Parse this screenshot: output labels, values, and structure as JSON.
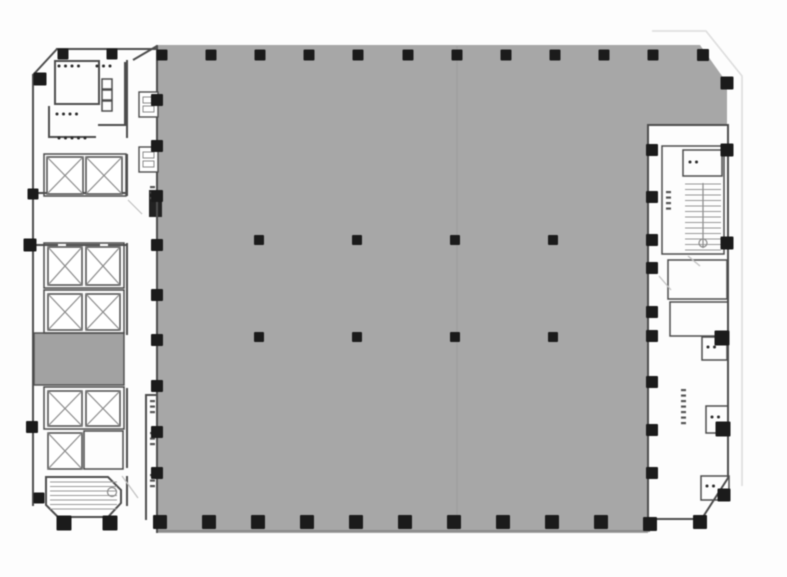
{
  "canvas": {
    "width": 787,
    "height": 577
  },
  "colors": {
    "background": "#fdfdfd",
    "open_area_fill": "#a7a7a7",
    "service_room_fill": "#a2a2a2",
    "wall": "#4d4d4d",
    "wall_light": "#8a8a8a",
    "column": "#1b1b1b",
    "faint_outline": "#dcdcdc",
    "tread": "#999999",
    "mark": "#2a2a2a",
    "door": "#c0c0c0",
    "seam": "rgba(100,100,100,0.14)"
  },
  "floor_plan": {
    "open_area_path": "M157,45 L700,45 L727,83 L727,125 L648,125 L648,533 L157,533 Z",
    "faint_outline_path": "M652,31 L706,31 L742,76 L742,486",
    "seam_line": {
      "x1": 457,
      "y1": 46,
      "x2": 457,
      "y2": 532
    },
    "gray_bottom_edge": {
      "x1": 157,
      "y1": 531,
      "x2": 650,
      "y2": 531
    },
    "columns": [
      {
        "x": 162,
        "y": 55,
        "s": 11
      },
      {
        "x": 211,
        "y": 55,
        "s": 11
      },
      {
        "x": 260,
        "y": 55,
        "s": 11
      },
      {
        "x": 309,
        "y": 55,
        "s": 11
      },
      {
        "x": 358,
        "y": 55,
        "s": 11
      },
      {
        "x": 408,
        "y": 55,
        "s": 11
      },
      {
        "x": 457,
        "y": 55,
        "s": 11
      },
      {
        "x": 506,
        "y": 55,
        "s": 11
      },
      {
        "x": 555,
        "y": 55,
        "s": 11
      },
      {
        "x": 604,
        "y": 55,
        "s": 11
      },
      {
        "x": 653,
        "y": 55,
        "s": 11
      },
      {
        "x": 703,
        "y": 55,
        "s": 12
      },
      {
        "x": 727,
        "y": 83,
        "s": 13
      },
      {
        "x": 727,
        "y": 150,
        "s": 13
      },
      {
        "x": 727,
        "y": 243,
        "s": 13
      },
      {
        "x": 722,
        "y": 338,
        "s": 15
      },
      {
        "x": 723,
        "y": 429,
        "s": 15
      },
      {
        "x": 724,
        "y": 495,
        "s": 13
      },
      {
        "x": 652,
        "y": 150,
        "s": 12
      },
      {
        "x": 652,
        "y": 197,
        "s": 12
      },
      {
        "x": 652,
        "y": 240,
        "s": 12
      },
      {
        "x": 652,
        "y": 268,
        "s": 12
      },
      {
        "x": 652,
        "y": 312,
        "s": 12
      },
      {
        "x": 652,
        "y": 336,
        "s": 12
      },
      {
        "x": 652,
        "y": 382,
        "s": 12
      },
      {
        "x": 652,
        "y": 430,
        "s": 12
      },
      {
        "x": 652,
        "y": 473,
        "s": 12
      },
      {
        "x": 160,
        "y": 522,
        "s": 14
      },
      {
        "x": 209,
        "y": 522,
        "s": 14
      },
      {
        "x": 258,
        "y": 522,
        "s": 14
      },
      {
        "x": 307,
        "y": 522,
        "s": 14
      },
      {
        "x": 356,
        "y": 522,
        "s": 14
      },
      {
        "x": 405,
        "y": 522,
        "s": 14
      },
      {
        "x": 454,
        "y": 522,
        "s": 14
      },
      {
        "x": 503,
        "y": 522,
        "s": 14
      },
      {
        "x": 552,
        "y": 522,
        "s": 14
      },
      {
        "x": 601,
        "y": 522,
        "s": 14
      },
      {
        "x": 650,
        "y": 524,
        "s": 14
      },
      {
        "x": 700,
        "y": 522,
        "s": 14
      },
      {
        "x": 157,
        "y": 100,
        "s": 12
      },
      {
        "x": 157,
        "y": 146,
        "s": 12
      },
      {
        "x": 157,
        "y": 196,
        "s": 12
      },
      {
        "x": 157,
        "y": 245,
        "s": 12
      },
      {
        "x": 157,
        "y": 295,
        "s": 12
      },
      {
        "x": 157,
        "y": 340,
        "s": 12
      },
      {
        "x": 157,
        "y": 386,
        "s": 12
      },
      {
        "x": 157,
        "y": 432,
        "s": 12
      },
      {
        "x": 157,
        "y": 473,
        "s": 12
      },
      {
        "x": 259,
        "y": 240,
        "s": 10
      },
      {
        "x": 357,
        "y": 240,
        "s": 10
      },
      {
        "x": 455,
        "y": 240,
        "s": 10
      },
      {
        "x": 553,
        "y": 240,
        "s": 10
      },
      {
        "x": 259,
        "y": 337,
        "s": 10
      },
      {
        "x": 357,
        "y": 337,
        "s": 10
      },
      {
        "x": 455,
        "y": 337,
        "s": 10
      },
      {
        "x": 553,
        "y": 337,
        "s": 10
      },
      {
        "x": 63,
        "y": 54,
        "s": 11
      },
      {
        "x": 112,
        "y": 54,
        "s": 11
      },
      {
        "x": 40,
        "y": 79,
        "s": 13
      },
      {
        "x": 33,
        "y": 194,
        "s": 11
      },
      {
        "x": 30,
        "y": 245,
        "s": 13
      },
      {
        "x": 32,
        "y": 427,
        "s": 12
      },
      {
        "x": 39,
        "y": 498,
        "s": 11
      },
      {
        "x": 64,
        "y": 523,
        "s": 15
      },
      {
        "x": 110,
        "y": 523,
        "s": 15
      }
    ],
    "walls": [
      {
        "x": 32,
        "y": 74,
        "w": 2,
        "h": 432
      },
      {
        "x": 56,
        "y": 48,
        "w": 102,
        "h": 2
      },
      {
        "x": 54,
        "y": 60,
        "w": 2,
        "h": 45
      },
      {
        "x": 54,
        "y": 60,
        "w": 46,
        "h": 2
      },
      {
        "x": 98,
        "y": 60,
        "w": 2,
        "h": 45
      },
      {
        "x": 54,
        "y": 103,
        "w": 46,
        "h": 2
      },
      {
        "x": 124,
        "y": 62,
        "w": 2,
        "h": 64
      },
      {
        "x": 98,
        "y": 124,
        "w": 28,
        "h": 2
      },
      {
        "x": 48,
        "y": 106,
        "w": 2,
        "h": 32
      },
      {
        "x": 48,
        "y": 136,
        "w": 48,
        "h": 2
      },
      {
        "x": 126,
        "y": 60,
        "w": 2,
        "h": 78
      },
      {
        "x": 126,
        "y": 154,
        "w": 2,
        "h": 42
      },
      {
        "x": 126,
        "y": 243,
        "w": 2,
        "h": 92
      },
      {
        "x": 126,
        "y": 388,
        "w": 2,
        "h": 80
      },
      {
        "x": 126,
        "y": 476,
        "w": 2,
        "h": 30
      },
      {
        "x": 36,
        "y": 192,
        "w": 22,
        "h": 2
      },
      {
        "x": 66,
        "y": 192,
        "w": 34,
        "h": 2
      },
      {
        "x": 108,
        "y": 192,
        "w": 18,
        "h": 2
      },
      {
        "x": 36,
        "y": 244,
        "w": 22,
        "h": 2
      },
      {
        "x": 66,
        "y": 244,
        "w": 34,
        "h": 2
      },
      {
        "x": 108,
        "y": 244,
        "w": 18,
        "h": 2
      },
      {
        "x": 145,
        "y": 394,
        "w": 2,
        "h": 126
      },
      {
        "x": 145,
        "y": 394,
        "w": 13,
        "h": 2
      },
      {
        "x": 156,
        "y": 45,
        "w": 2,
        "h": 488
      },
      {
        "x": 647,
        "y": 125,
        "w": 2,
        "h": 395
      },
      {
        "x": 647,
        "y": 124,
        "w": 82,
        "h": 2
      },
      {
        "x": 727,
        "y": 125,
        "w": 2,
        "h": 354
      },
      {
        "x": 648,
        "y": 518,
        "w": 54,
        "h": 2
      }
    ],
    "diag_walls": [
      {
        "x1": 33,
        "y1": 75,
        "x2": 57,
        "y2": 49
      },
      {
        "x1": 133,
        "y1": 60,
        "x2": 157,
        "y2": 46
      },
      {
        "x1": 728,
        "y1": 478,
        "x2": 701,
        "y2": 520
      }
    ],
    "room_outlines": [
      {
        "x": 44,
        "y": 154,
        "w": 82,
        "h": 42
      },
      {
        "x": 44,
        "y": 243,
        "w": 80,
        "h": 45
      },
      {
        "x": 44,
        "y": 290,
        "w": 80,
        "h": 43
      },
      {
        "x": 44,
        "y": 387,
        "w": 80,
        "h": 42
      },
      {
        "x": 84,
        "y": 431,
        "w": 39,
        "h": 38
      },
      {
        "x": 662,
        "y": 146,
        "w": 62,
        "h": 108
      },
      {
        "x": 683,
        "y": 150,
        "w": 39,
        "h": 26
      },
      {
        "x": 668,
        "y": 260,
        "w": 59,
        "h": 39
      },
      {
        "x": 670,
        "y": 302,
        "w": 58,
        "h": 34
      },
      {
        "x": 702,
        "y": 337,
        "w": 25,
        "h": 23
      },
      {
        "x": 706,
        "y": 406,
        "w": 22,
        "h": 27
      },
      {
        "x": 701,
        "y": 476,
        "w": 28,
        "h": 24
      },
      {
        "x": 102,
        "y": 79,
        "w": 10,
        "h": 10
      },
      {
        "x": 102,
        "y": 90,
        "w": 10,
        "h": 10
      },
      {
        "x": 102,
        "y": 101,
        "w": 10,
        "h": 10
      }
    ],
    "filled_rooms": [
      {
        "x": 34,
        "y": 333,
        "w": 90,
        "h": 52,
        "fill": "service"
      },
      {
        "x": 149,
        "y": 190,
        "w": 13,
        "h": 27,
        "fill": "dark"
      }
    ],
    "elevators": [
      {
        "x": 47,
        "y": 157,
        "w": 36,
        "h": 37
      },
      {
        "x": 86,
        "y": 157,
        "w": 36,
        "h": 37
      },
      {
        "x": 48,
        "y": 247,
        "w": 34,
        "h": 38
      },
      {
        "x": 86,
        "y": 247,
        "w": 34,
        "h": 38
      },
      {
        "x": 48,
        "y": 294,
        "w": 34,
        "h": 36
      },
      {
        "x": 86,
        "y": 294,
        "w": 34,
        "h": 36
      },
      {
        "x": 48,
        "y": 391,
        "w": 34,
        "h": 35
      },
      {
        "x": 86,
        "y": 391,
        "w": 34,
        "h": 35
      },
      {
        "x": 48,
        "y": 433,
        "w": 34,
        "h": 36
      }
    ],
    "stairs_left": {
      "polygon": "46,477 108,477 121,490 121,503 108,517 58,517 46,505",
      "treads": {
        "x1": 50,
        "x2": 117,
        "y1": 482,
        "y2": 513,
        "step": 4.5
      },
      "circle": {
        "cx": 112,
        "cy": 492,
        "r": 4.5
      }
    },
    "stairs_right": {
      "treads": {
        "x1": 685,
        "x2": 721,
        "y1": 184,
        "y2": 250,
        "step": 5.5
      },
      "center_line": {
        "x1": 703,
        "y1": 183,
        "x2": 703,
        "y2": 248
      },
      "circle": {
        "cx": 703,
        "cy": 243,
        "r": 4
      }
    },
    "small_boxes": [
      {
        "x": 139,
        "y": 92,
        "w": 19,
        "h": 25
      },
      {
        "x": 139,
        "y": 147,
        "w": 19,
        "h": 25
      }
    ],
    "label_dot_rows": [
      {
        "x": 59,
        "y": 66,
        "n": 4
      },
      {
        "x": 97,
        "y": 66,
        "n": 3
      },
      {
        "x": 57,
        "y": 114,
        "n": 4
      },
      {
        "x": 59,
        "y": 138,
        "n": 5
      },
      {
        "x": 690,
        "y": 162,
        "n": 2
      },
      {
        "x": 708,
        "y": 347,
        "n": 2
      },
      {
        "x": 712,
        "y": 417,
        "n": 2
      },
      {
        "x": 707,
        "y": 486,
        "n": 2
      }
    ],
    "label_dash_cols": [
      {
        "x": 150,
        "y": 186,
        "n": 3
      },
      {
        "x": 150,
        "y": 400,
        "n": 3
      },
      {
        "x": 150,
        "y": 432,
        "n": 3
      },
      {
        "x": 150,
        "y": 474,
        "n": 3
      },
      {
        "x": 666,
        "y": 191,
        "n": 4
      },
      {
        "x": 681,
        "y": 389,
        "n": 7
      }
    ],
    "door_lines": [
      {
        "x1": 128,
        "y1": 200,
        "x2": 142,
        "y2": 214
      },
      {
        "x1": 122,
        "y1": 476,
        "x2": 138,
        "y2": 498
      },
      {
        "x1": 659,
        "y1": 276,
        "x2": 671,
        "y2": 290
      },
      {
        "x1": 688,
        "y1": 256,
        "x2": 700,
        "y2": 266
      }
    ]
  }
}
